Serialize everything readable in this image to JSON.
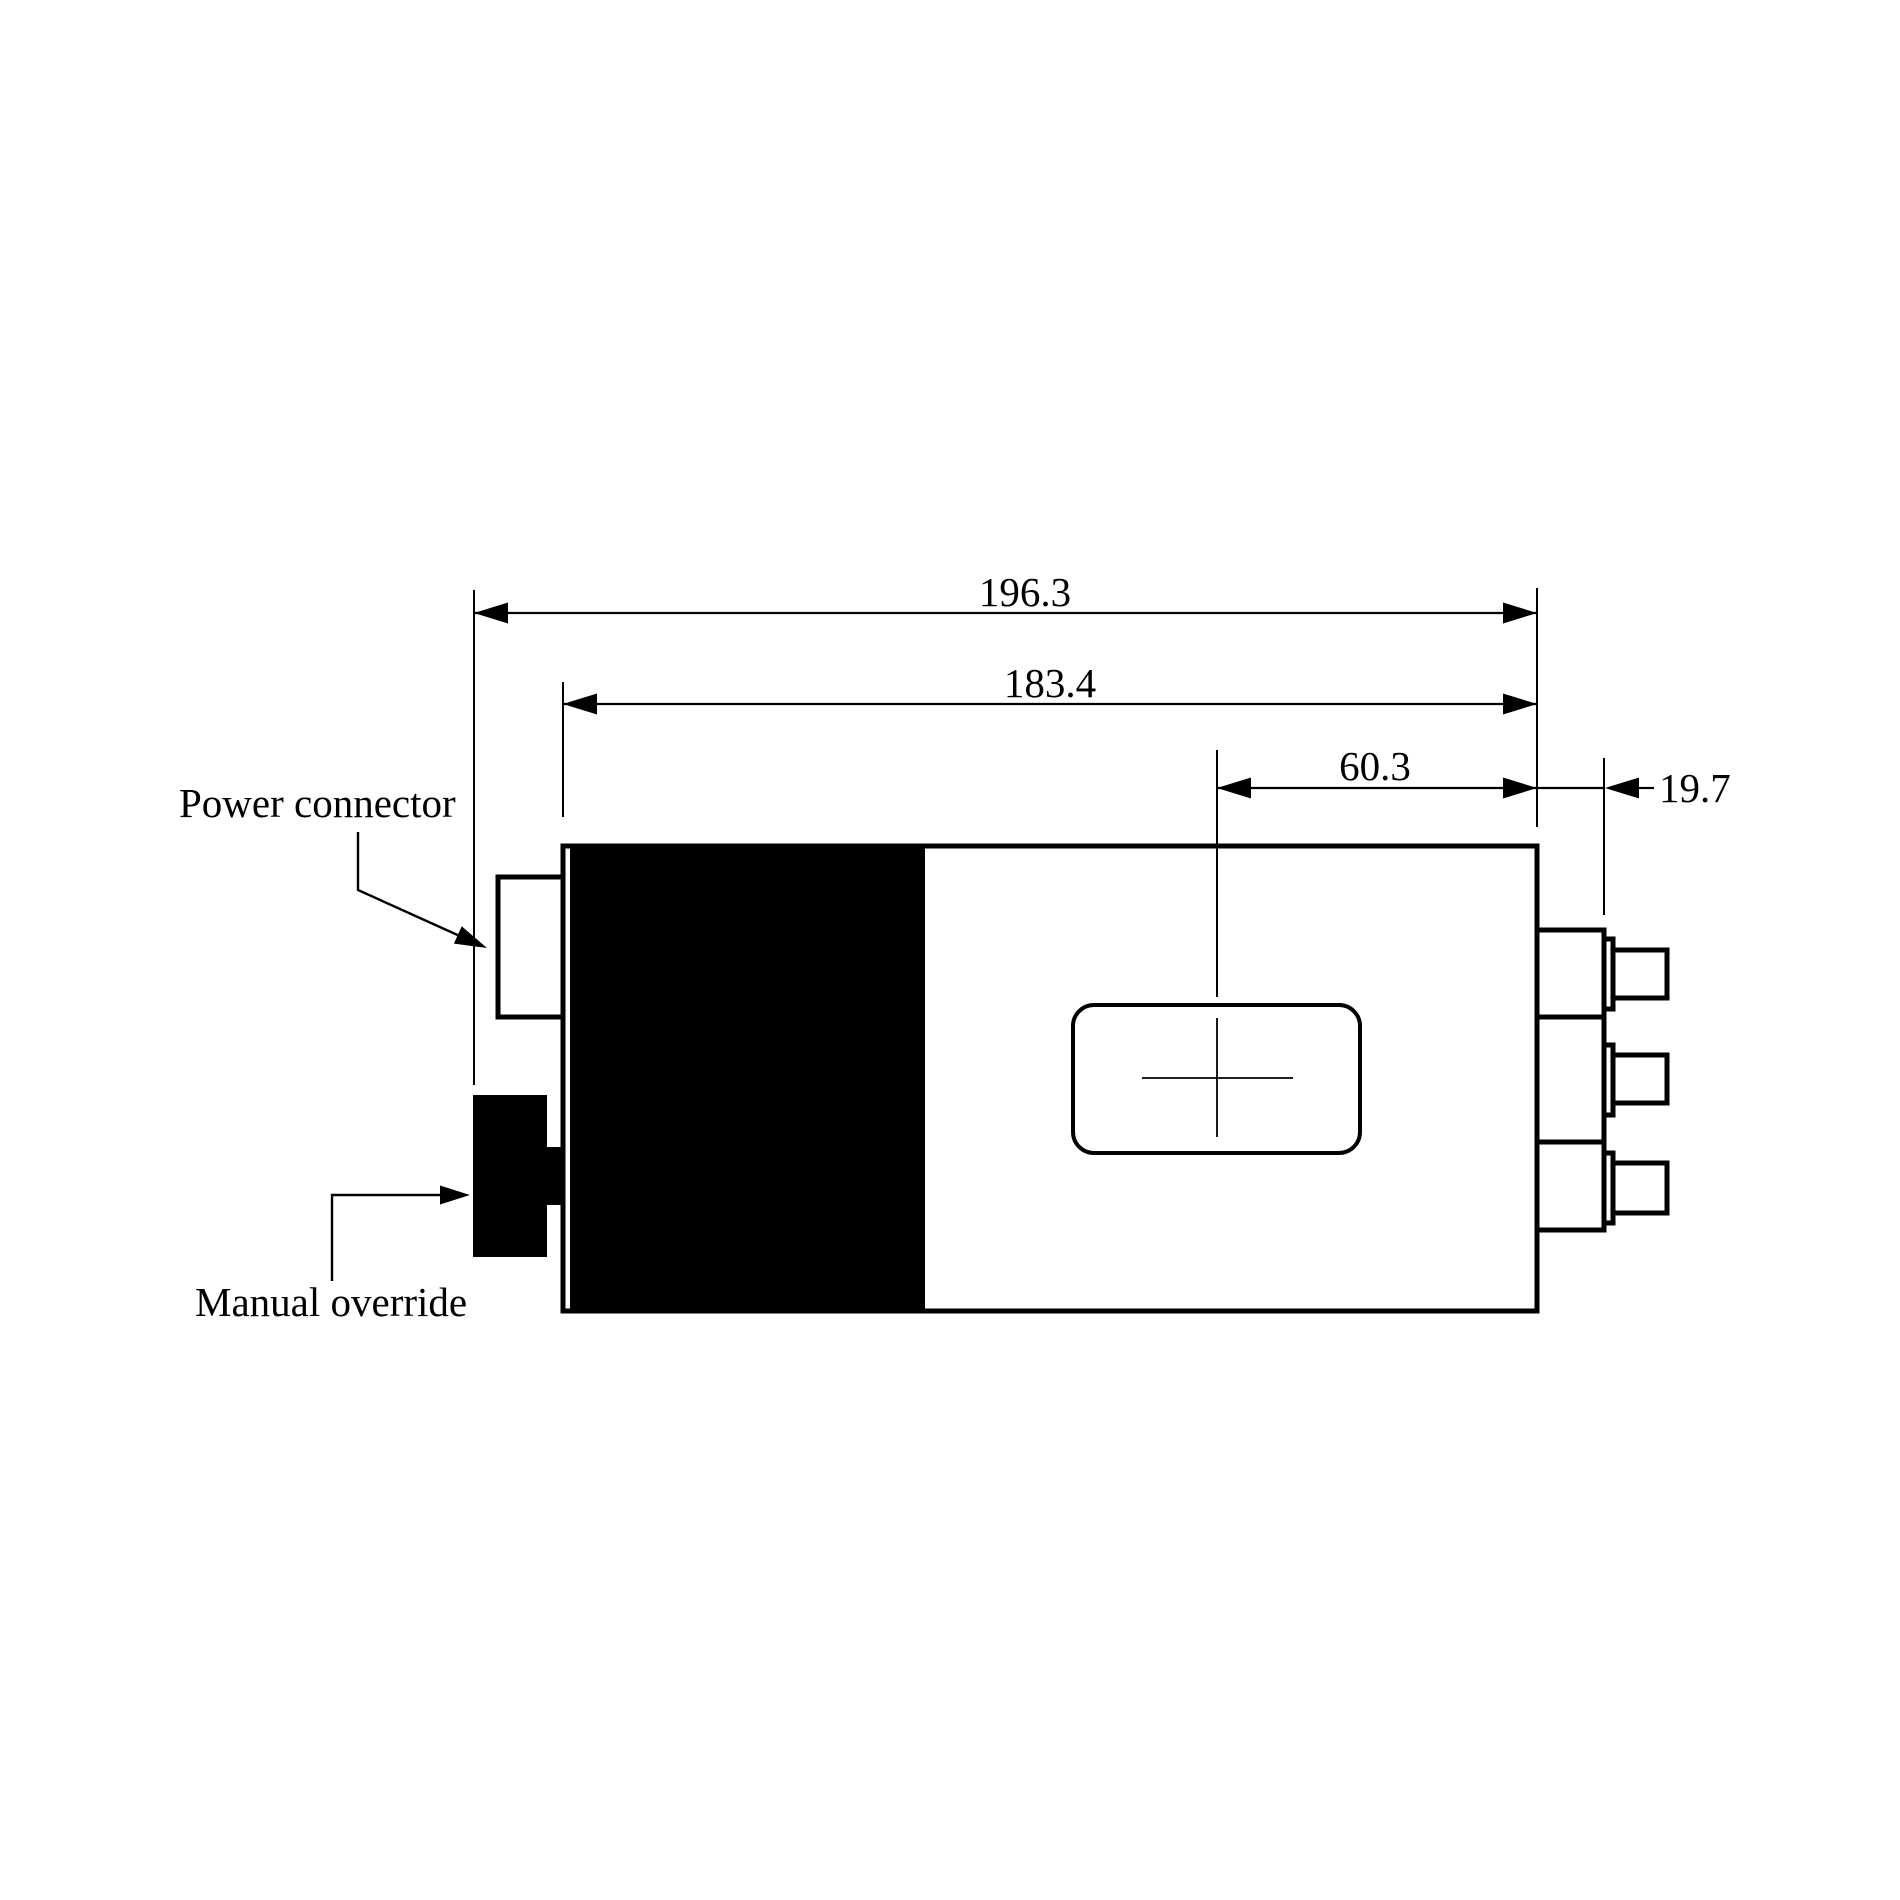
{
  "colors": {
    "ink": "#000000",
    "paper": "#ffffff"
  },
  "diagram": {
    "callouts": {
      "power_connector": "Power connector",
      "manual_override": "Manual override"
    },
    "dimensions": {
      "overall_width": "196.3",
      "body_width": "183.4",
      "port_center_offset": "60.3",
      "connector_protrusion": "19.7"
    }
  }
}
